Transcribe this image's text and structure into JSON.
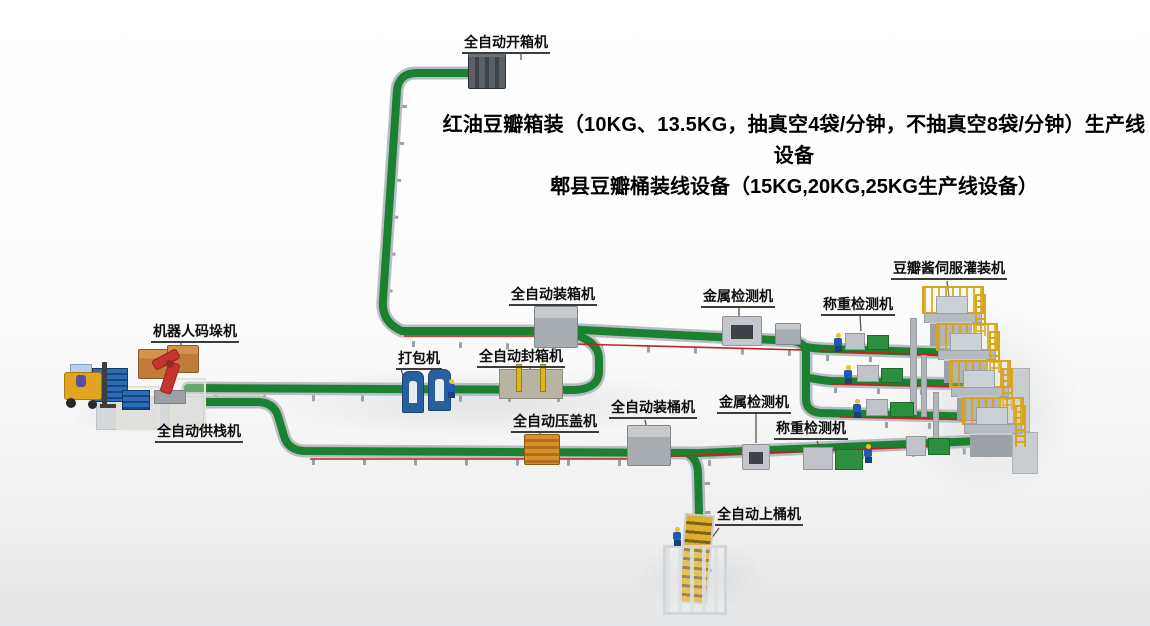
{
  "title": {
    "line1": "红油豆瓣箱装（10KG、13.5KG，抽真空4袋/分钟，不抽真空8袋/分钟）生产线设备",
    "line2": "郫县豆瓣桶装线设备（15KG,20KG,25KG生产线设备）"
  },
  "labels": {
    "carton_opener": "全自动开箱机",
    "robot_palletizer": "机器人码垛机",
    "pallet_feeder": "全自动供栈机",
    "strapping_machine": "打包机",
    "carton_sealer": "全自动封箱机",
    "case_packer": "全自动装箱机",
    "capping_machine": "全自动压盖机",
    "barrel_packer": "全自动装桶机",
    "metal_detector_top": "金属检测机",
    "checkweigher_top": "称重检测机",
    "servo_filler": "豆瓣酱伺服灌装机",
    "metal_detector_bottom": "金属检测机",
    "checkweigher_bottom": "称重检测机",
    "barrel_loader": "全自动上桶机"
  },
  "colors": {
    "background": "#ffffff",
    "conveyor_green": "#1a8130",
    "conveyor_rail": "#b9bdc1",
    "laser_red": "#c32222",
    "platform_yellow": "#d8a61c",
    "machine_gray": "#a8adb2",
    "strapper_blue": "#2a5f9e",
    "capper_orange": "#d98f2b",
    "robot_red": "#c6342c",
    "pallet_blue": "#1f5fa8",
    "box_orange": "#c07b3a",
    "forklift_yellow": "#e2a51f",
    "worker_blue": "#2157b5",
    "helmet_yellow": "#e8c31d"
  }
}
